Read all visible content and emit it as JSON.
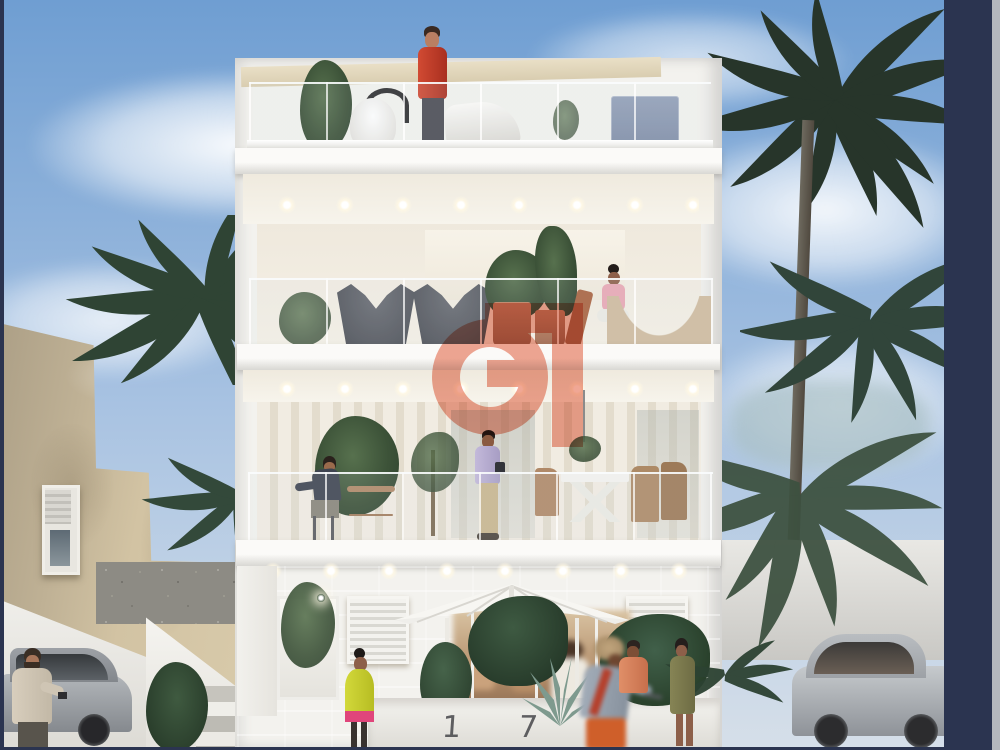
{
  "meta": {
    "description": "Real-estate 3D rendering: modern white 4-storey apartment building with glass balconies at dusk lighting, palm trees, pedestrians and parked cars",
    "style": "architectural visualization"
  },
  "watermark": {
    "letter": "G",
    "color": "#eb8971",
    "opacity": 0.75
  },
  "building": {
    "house_number": "1 7",
    "floors": [
      "roof-terrace",
      "upper-balcony",
      "lower-balcony",
      "ground-floor"
    ],
    "facade": "white render with glass balustrades",
    "ground_facade": "sandstone block cladding",
    "downlight_rows": 3,
    "features": [
      "glass balustrades",
      "recessed ceiling downlights",
      "white parasol over terrace",
      "entrance door",
      "slatted-blind windows",
      "hanging chair",
      "butterfly chairs",
      "x-leg dining table"
    ]
  },
  "people": [
    {
      "name": "man-red-shirt-roof",
      "clothing": "#c23b28"
    },
    {
      "name": "woman-pink-top-hammock",
      "clothing": "#e8a7b4"
    },
    {
      "name": "man-lavender-shirt-balcony",
      "clothing": "#b9aed2"
    },
    {
      "name": "man-dark-jacket-balcony",
      "clothing": "#3e4350"
    },
    {
      "name": "woman-yellow-tunic-steps",
      "clothing": "#c3ca2f"
    },
    {
      "name": "woman-headwrap-orange-skirt",
      "clothing": "#96a0ac"
    },
    {
      "name": "man-coral-shirt",
      "clothing": "#d8825f"
    },
    {
      "name": "woman-olive-dress",
      "clothing": "#7d7b50"
    },
    {
      "name": "man-beside-car",
      "clothing": "#cfc5b4"
    }
  ],
  "vehicles": [
    {
      "name": "silver-sedan-left",
      "color": "#9da1a6"
    },
    {
      "name": "silver-hatchback-right",
      "color": "#aeb2b6"
    }
  ],
  "environment": [
    "blue sky with wispy clouds",
    "date palms left",
    "dense palm cluster right",
    "old beige masonry house",
    "rubble stone wall",
    "white boundary walls and steps",
    "agave and tropical planting"
  ],
  "colors": {
    "navy": "#2b3450",
    "edgeGray": "#b4b7bd",
    "skyTop": "#6f9ed2",
    "oldBuilding": "#d2c3a3",
    "sandstone": "#d8c49c",
    "palmDark": "#27352a",
    "palmMid": "#3d5140",
    "watermark": "#eb8971",
    "buildingWhite": "#f3f2ee",
    "terracotta": "#c08262",
    "hammockTan": "#cfbb9e",
    "cabinetBlue": "#7e8ca6"
  }
}
